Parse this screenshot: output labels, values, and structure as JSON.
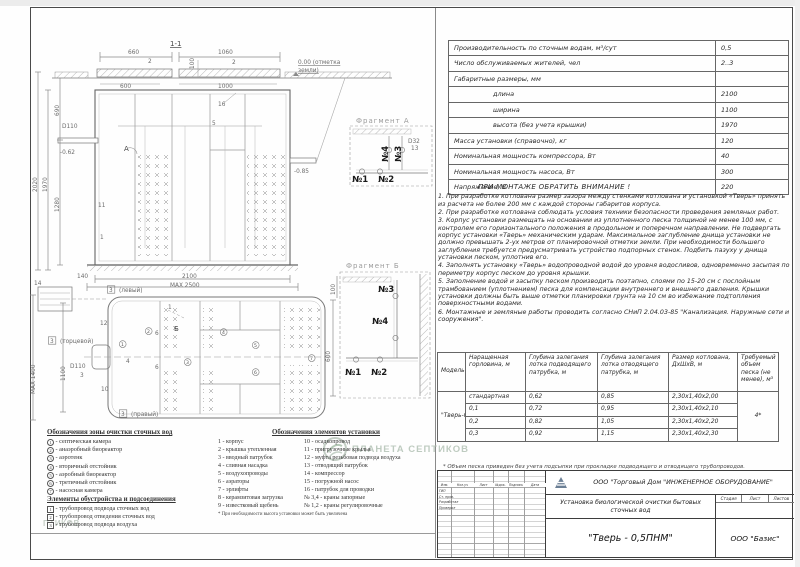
{
  "spec_table": {
    "rows": [
      {
        "label": "Производительность по сточным водам, м³/сут",
        "value": "0,5"
      },
      {
        "label": "Число обслуживаемых жителей, чел",
        "value": "2..3"
      },
      {
        "label": "Габаритные размеры, мм",
        "value": ""
      },
      {
        "label": "длина",
        "value": "2100"
      },
      {
        "label": "ширина",
        "value": "1100"
      },
      {
        "label": "высота (без учета крышки)",
        "value": "1970"
      },
      {
        "label": "Масса установки (справочно), кг",
        "value": "120"
      },
      {
        "label": "Номинальная мощность компрессора, Вт",
        "value": "40"
      },
      {
        "label": "Номинальная мощность насоса, Вт",
        "value": "300"
      },
      {
        "label": "Напряжение, В",
        "value": "220"
      }
    ]
  },
  "notes": {
    "title": "ПРИ МОНТАЖЕ ОБРАТИТЬ ВНИМАНИЕ !",
    "items": [
      "1.   При разработке котлована размер зазора между стенками котлована и установкой «Тверь» принять из расчета не более 200 мм с каждой стороны габаритов корпуса.",
      "2.   При разработке котлована соблюдать условия техники безопасности проведения земляных работ.",
      "3.   Корпус установки размещать на основании из уплотненного песка толщиной не менее 100 мм, с контролем его горизонтального положения в продольном и поперечном направлении. Не подвергать корпус установки «Тверь» механическим ударам. Максимальное заглубление днища установки не должно превышать 2-ух метров от планировочной отметки земли. При необходимости большего заглубления требуется предусматривать устройство подпорных стенок. Подбить пазуху у днища установки песком, уплотнив его.",
      "4.   Заполнять установку «Тверь» водопроводной водой до уровня водосливов, одновременно засыпая по периметру корпус песком до уровня крышки.",
      "5.   Заполнение водой и засыпку песком производить поэтапно, слоями по 15-20 см с послойным трамбованием (уплотнением) песка для компенсации внутреннего и внешнего давления. Крышки установки должны быть выше отметки планировки грунта на 10 см во избежание подтопления поверхностными водами.",
      "6.   Монтажные и земляные работы проводить согласно СНиП 2.04.03-85 \"Канализация. Наружные сети и сооружения\"."
    ]
  },
  "model_table": {
    "headers": [
      "Модель",
      "Наращенная горловина, м",
      "Глубина залегания лотка подводящего патрубка, м",
      "Глубина залегания лотка отводящего патрубка, м",
      "Размер котлована, ДхШхВ, м",
      "Требуемый объем песка (не менее), м³"
    ],
    "model": "\"Тверь-0,5ПНМ\"",
    "sand": "4*",
    "rows": [
      [
        "стандартная",
        "0,62",
        "0,85",
        "2,30х1,40х2,00"
      ],
      [
        "0,1",
        "0,72",
        "0,95",
        "2,30х1,40х2,10"
      ],
      [
        "0,2",
        "0,82",
        "1,05",
        "2,30х1,40х2,20"
      ],
      [
        "0,3",
        "0,92",
        "1,15",
        "2,30х1,40х2,30"
      ]
    ],
    "footnote": "* Объем песка приведен без учета подсыпки при прокладке подводящего и отводящего трубопроводов."
  },
  "legend_zones": {
    "title": "Обозначения зоны очистки сточных вод",
    "items": [
      {
        "n": "1",
        "text": "септическая камера"
      },
      {
        "n": "2",
        "text": "анаэробный биореактор"
      },
      {
        "n": "3",
        "text": "аэротенк"
      },
      {
        "n": "4",
        "text": "вторичный отстойник"
      },
      {
        "n": "5",
        "text": "аэробный биореактор"
      },
      {
        "n": "6",
        "text": "третичный отстойник"
      },
      {
        "n": "7",
        "text": "насосная камера"
      }
    ]
  },
  "legend_utility": {
    "title": "Элементы обустройства и подсоединения",
    "items": [
      {
        "n": "1",
        "text": "трубопровод подвода сточных вод"
      },
      {
        "n": "2",
        "text": "трубопровод отведения сточных вод"
      },
      {
        "n": "3",
        "text": "трубопровод подвода воздуха"
      }
    ]
  },
  "legend_elements": {
    "title": "Обозначения элементов установки",
    "col1": [
      {
        "n": "1",
        "text": "корпус"
      },
      {
        "n": "2",
        "text": "крышка утепленная"
      },
      {
        "n": "3",
        "text": "вводный патрубок"
      },
      {
        "n": "4",
        "text": "сливная насадка"
      },
      {
        "n": "5",
        "text": "воздухопроводы"
      },
      {
        "n": "6",
        "text": "аэраторы"
      },
      {
        "n": "7",
        "text": "эрлифты"
      },
      {
        "n": "8",
        "text": "керамзитовая загрузка"
      },
      {
        "n": "9",
        "text": "известковый щебень"
      }
    ],
    "col2": [
      {
        "n": "10",
        "text": "осадкопровод"
      },
      {
        "n": "11",
        "text": "пригрузочные крылья"
      },
      {
        "n": "12",
        "text": "муфта резьбовая подвода воздуха"
      },
      {
        "n": "13",
        "text": "отводящий патрубок"
      },
      {
        "n": "14",
        "text": "компрессор"
      },
      {
        "n": "15",
        "text": "погружной насос"
      },
      {
        "n": "16",
        "text": "патрубок для проводки"
      },
      {
        "n": "№ 3,4",
        "text": "краны запорные"
      },
      {
        "n": "№ 1,2",
        "text": "краны регулировочные"
      }
    ],
    "footnote": "* При необходимости высота установки может быть увеличена"
  },
  "titleblock": {
    "company": "ООО \"Торговый Дом \"ИНЖЕНЕРНОЕ ОБОРУДОВАНИЕ\"",
    "doc_title": "Установка биологической очистки бытовых сточных вод",
    "doc_name": "\"Тверь - 0,5ПНМ\"",
    "org": "ООО \"Базис\"",
    "stage_headers": [
      "Стадия",
      "Лист",
      "Листов"
    ],
    "rev_headers": [
      "Изм.",
      "Кол.уч",
      "Лист",
      "№док.",
      "Подпись",
      "Дата"
    ],
    "row_labels": [
      "ГИП",
      "Ст. пров.",
      "Разработал",
      "Проверил"
    ],
    "company_logo_icon": "td-io-diamond-logo"
  },
  "watermark": {
    "text": "ПЛАНЕТА СЕПТИКОВ",
    "partial_text": "ПТИКОВ",
    "color": "#b4c3b6",
    "logo_icon": "globe-leaf-logo"
  },
  "drawing": {
    "labels": [
      {
        "text": "1-1",
        "x": 170,
        "y": 46,
        "cls": "lbl",
        "u": true
      },
      {
        "text": "660",
        "x": 128,
        "y": 54,
        "cls": "dim"
      },
      {
        "text": "2",
        "x": 148,
        "y": 63,
        "cls": "dim"
      },
      {
        "text": "1060",
        "x": 218,
        "y": 54,
        "cls": "dim"
      },
      {
        "text": "2",
        "x": 232,
        "y": 64,
        "cls": "dim"
      },
      {
        "text": "100",
        "x": 194,
        "y": 69,
        "cls": "dim",
        "rot": -90
      },
      {
        "text": "600",
        "x": 120,
        "y": 88,
        "cls": "dim"
      },
      {
        "text": "1000",
        "x": 218,
        "y": 88,
        "cls": "dim"
      },
      {
        "text": "0.00 (отметка",
        "x": 298,
        "y": 64,
        "cls": "dim",
        "u": true
      },
      {
        "text": "земли)",
        "x": 298,
        "y": 72,
        "cls": "dim",
        "u": true
      },
      {
        "text": "2020",
        "x": 37,
        "y": 192,
        "cls": "dim",
        "rot": -90
      },
      {
        "text": "1970",
        "x": 47,
        "y": 192,
        "cls": "dim",
        "rot": -90
      },
      {
        "text": "1280",
        "x": 59,
        "y": 212,
        "cls": "dim",
        "rot": -90
      },
      {
        "text": "690",
        "x": 59,
        "y": 116,
        "cls": "dim",
        "rot": -90
      },
      {
        "text": "D110",
        "x": 62,
        "y": 128,
        "cls": "dim"
      },
      {
        "text": "-0.62",
        "x": 60,
        "y": 154,
        "cls": "dim"
      },
      {
        "text": "16",
        "x": 218,
        "y": 106,
        "cls": "dim"
      },
      {
        "text": "5",
        "x": 212,
        "y": 125,
        "cls": "dim"
      },
      {
        "text": "А",
        "x": 124,
        "y": 151,
        "cls": "lbl"
      },
      {
        "text": "11",
        "x": 98,
        "y": 207,
        "cls": "dim"
      },
      {
        "text": "1",
        "x": 100,
        "y": 239,
        "cls": "dim"
      },
      {
        "text": "-0.85",
        "x": 294,
        "y": 173,
        "cls": "dim"
      },
      {
        "text": "140",
        "x": 77,
        "y": 278,
        "cls": "dim"
      },
      {
        "text": "2100",
        "x": 182,
        "y": 278,
        "cls": "dim"
      },
      {
        "text": "MAX 2500",
        "x": 170,
        "y": 287,
        "cls": "dim"
      },
      {
        "text": "Фрагмент А",
        "x": 356,
        "y": 123,
        "cls": "frag"
      },
      {
        "text": "№4",
        "x": 388,
        "y": 162,
        "cls": "big",
        "rot": -90
      },
      {
        "text": "№3",
        "x": 401,
        "y": 162,
        "cls": "big",
        "rot": -90
      },
      {
        "text": "D32",
        "x": 408,
        "y": 143,
        "cls": "dim"
      },
      {
        "text": "13",
        "x": 411,
        "y": 150,
        "cls": "dim"
      },
      {
        "text": "№1",
        "x": 352,
        "y": 182,
        "cls": "big"
      },
      {
        "text": "№2",
        "x": 378,
        "y": 182,
        "cls": "big"
      },
      {
        "text": "14",
        "x": 34,
        "y": 285,
        "cls": "dim"
      },
      {
        "text": "3",
        "x": 109,
        "y": 292,
        "cls": "dim",
        "box": true
      },
      {
        "text": "(левый)",
        "x": 119,
        "y": 292,
        "cls": "dim"
      },
      {
        "text": "1",
        "x": 168,
        "y": 309,
        "cls": "dim"
      },
      {
        "text": "12",
        "x": 100,
        "y": 325,
        "cls": "dim"
      },
      {
        "text": "3",
        "x": 50,
        "y": 343,
        "cls": "dim",
        "box": true
      },
      {
        "text": "(торцевой)",
        "x": 60,
        "y": 343,
        "cls": "dim"
      },
      {
        "text": "D110",
        "x": 70,
        "y": 368,
        "cls": "dim"
      },
      {
        "text": "3",
        "x": 80,
        "y": 377,
        "cls": "dim"
      },
      {
        "text": "10",
        "x": 101,
        "y": 391,
        "cls": "dim"
      },
      {
        "text": "3",
        "x": 121,
        "y": 416,
        "cls": "dim",
        "box": true
      },
      {
        "text": "(правый)",
        "x": 131,
        "y": 416,
        "cls": "dim"
      },
      {
        "text": "MAX 1400",
        "x": 35,
        "y": 394,
        "cls": "dim",
        "rot": -90
      },
      {
        "text": "1100",
        "x": 65,
        "y": 381,
        "cls": "dim",
        "rot": -90
      },
      {
        "text": "4",
        "x": 126,
        "y": 363,
        "cls": "dim"
      },
      {
        "text": "6",
        "x": 155,
        "y": 335,
        "cls": "dim"
      },
      {
        "text": "6",
        "x": 155,
        "y": 369,
        "cls": "dim"
      },
      {
        "text": "Б",
        "x": 174,
        "y": 331,
        "cls": "lbl"
      },
      {
        "text": "1",
        "x": 121,
        "y": 346,
        "shape": "circle"
      },
      {
        "text": "2",
        "x": 147,
        "y": 333,
        "shape": "circle"
      },
      {
        "text": "3",
        "x": 186,
        "y": 364,
        "shape": "circle"
      },
      {
        "text": "4",
        "x": 222,
        "y": 334,
        "shape": "circle"
      },
      {
        "text": "5",
        "x": 254,
        "y": 347,
        "shape": "circle"
      },
      {
        "text": "6",
        "x": 254,
        "y": 374,
        "shape": "circle"
      },
      {
        "text": "7",
        "x": 310,
        "y": 360,
        "shape": "circle"
      },
      {
        "text": "Фрагмент Б",
        "x": 346,
        "y": 268,
        "cls": "frag"
      },
      {
        "text": "№3",
        "x": 378,
        "y": 292,
        "cls": "big"
      },
      {
        "text": "№4",
        "x": 372,
        "y": 324,
        "cls": "big"
      },
      {
        "text": "№1",
        "x": 345,
        "y": 375,
        "cls": "big"
      },
      {
        "text": "№2",
        "x": 371,
        "y": 375,
        "cls": "big"
      },
      {
        "text": "600",
        "x": 330,
        "y": 362,
        "cls": "dim",
        "rot": -90
      },
      {
        "text": "100",
        "x": 335,
        "y": 295,
        "cls": "dim",
        "rot": -90
      }
    ]
  }
}
